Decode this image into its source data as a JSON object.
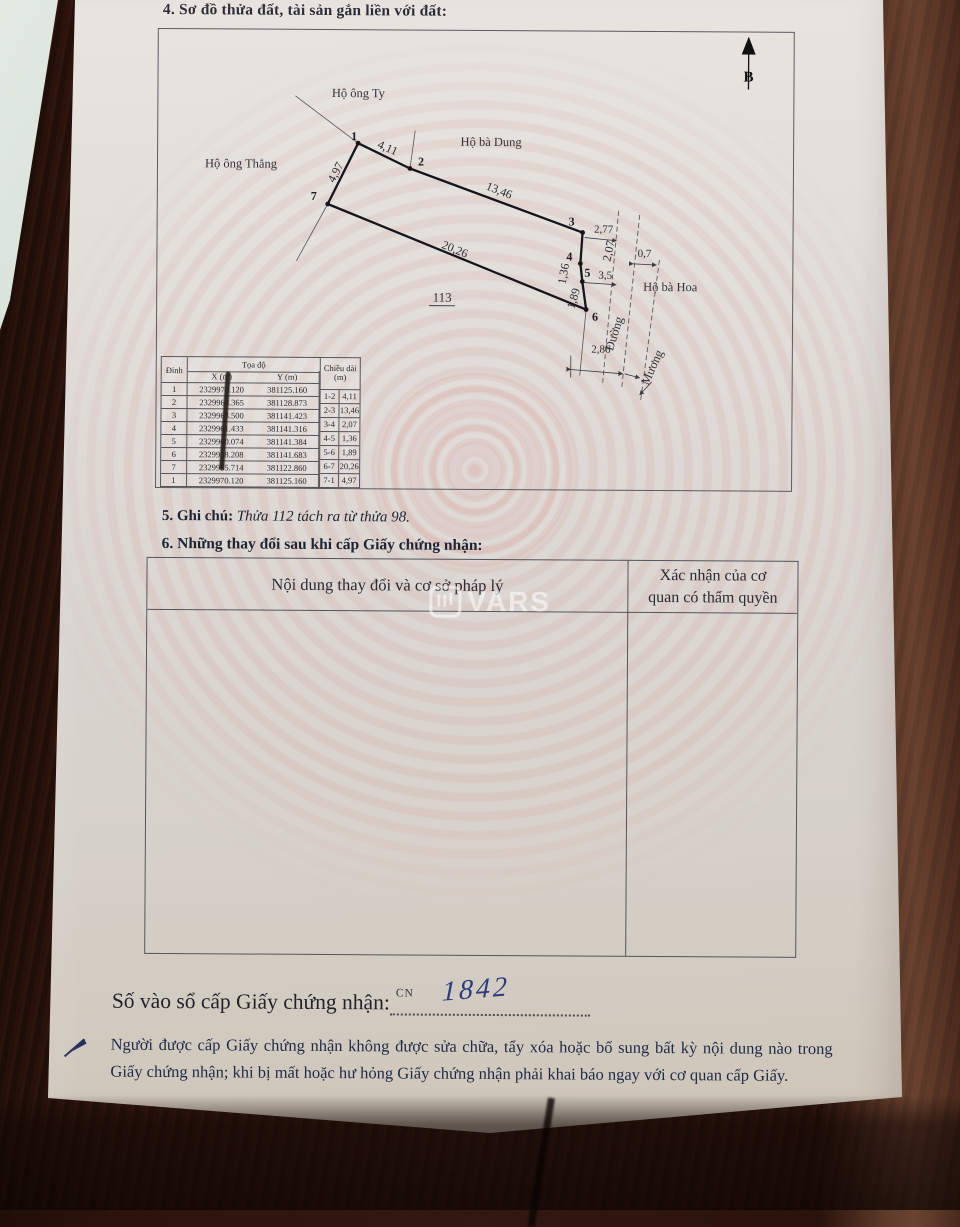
{
  "page": {
    "section4_title": "4. Sơ đồ thửa đất, tài sản gắn liền với đất:",
    "section5_label": "5. Ghi chú:",
    "section5_note": "Thửa 112 tách ra từ thửa 98.",
    "section6_title": "6. Những thay đổi sau khi cấp Giấy chứng nhận:",
    "watermark": "VARS",
    "registry_label": "Số vào sổ cấp Giấy chứng nhận:",
    "registry_prefix": "CN",
    "registry_number": "1842",
    "footer_text": "Người được cấp Giấy chứng nhận không được sửa chữa, tẩy xóa hoặc bổ sung bất kỳ nội dung nào trong Giấy chứng nhận; khi bị mất hoặc hư hỏng Giấy chứng nhận phải khai báo ngay với cơ quan cấp Giấy."
  },
  "diagram": {
    "north_label": "B",
    "plot_number": "113",
    "neighbors": {
      "top": "Hộ ông Ty",
      "right_top": "Hộ bà Dung",
      "left": "Hộ ông Thẳng",
      "right": "Hộ bà Hoa"
    },
    "road_label": "Đường",
    "canal_label": "Mương",
    "vertices": {
      "v1": "1",
      "v2": "2",
      "v3": "3",
      "v4": "4",
      "v5": "5",
      "v6": "6",
      "v7": "7"
    },
    "edge_lengths": {
      "e12": "4,11",
      "e23": "13,46",
      "e34": "2,07",
      "e45": "1,36",
      "e56": "1,89",
      "e67": "20,26",
      "e71": "4,97"
    },
    "measurements": {
      "to_road_top": "2,77",
      "to_road_mid": "3,5",
      "canal_width": "0,7",
      "to_road_bottom": "2,86"
    }
  },
  "coord_table": {
    "header": {
      "dinh": "Đỉnh",
      "toado": "Tọa độ",
      "x": "X (m)",
      "y": "Y (m)",
      "chieudai": "Chiều dài",
      "unit": "(m)"
    },
    "rows": [
      {
        "dinh": "1",
        "x": "2329970.120",
        "y": "381125.160"
      },
      {
        "dinh": "2",
        "x": "2329968.365",
        "y": "381128.873"
      },
      {
        "dinh": "3",
        "x": "2329963.500",
        "y": "381141.423"
      },
      {
        "dinh": "4",
        "x": "2329961.433",
        "y": "381141.316"
      },
      {
        "dinh": "5",
        "x": "2329960.074",
        "y": "381141.384"
      },
      {
        "dinh": "6",
        "x": "2329958.208",
        "y": "381141.683"
      },
      {
        "dinh": "7",
        "x": "2329965.714",
        "y": "381122.860"
      },
      {
        "dinh": "1",
        "x": "2329970.120",
        "y": "381125.160"
      }
    ],
    "lengths": [
      {
        "seg": "1-2",
        "val": "4,11"
      },
      {
        "seg": "2-3",
        "val": "13,46"
      },
      {
        "seg": "3-4",
        "val": "2,07"
      },
      {
        "seg": "4-5",
        "val": "1,36"
      },
      {
        "seg": "5-6",
        "val": "1,89"
      },
      {
        "seg": "6-7",
        "val": "20,26"
      },
      {
        "seg": "7-1",
        "val": "4,97"
      }
    ]
  },
  "changes_table": {
    "col1_header": "Nội dung thay đổi và cơ sở pháp lý",
    "col2_header_line1": "Xác nhận của cơ",
    "col2_header_line2": "quan có thẩm quyền"
  },
  "colors": {
    "paper": "#ded9d4",
    "wood_dark": "#2a120b",
    "wood_light": "#6b4431",
    "pattern_pink": "#e1a39c",
    "ink_blue": "#2c3a80",
    "line_gray": "#55555c"
  }
}
